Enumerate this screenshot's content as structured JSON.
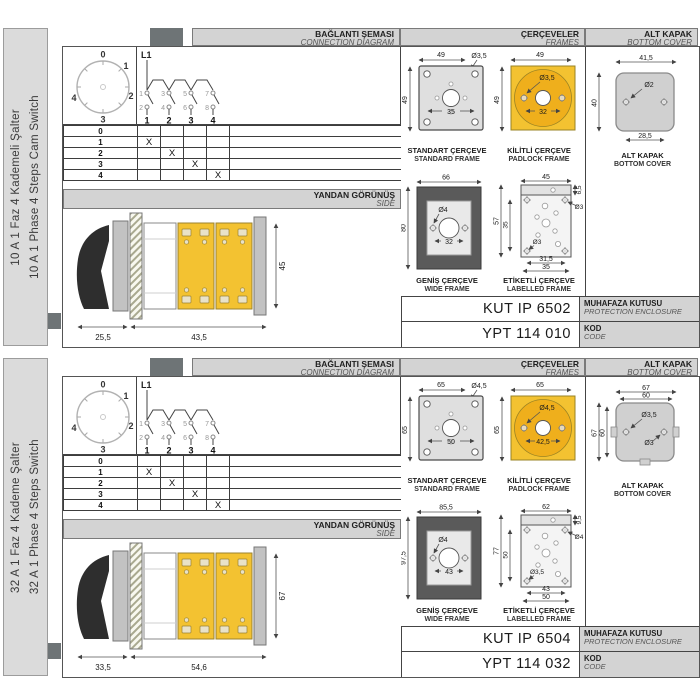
{
  "colors": {
    "yellow": "#F3C231",
    "amber": "#EFAF1C",
    "frame_gray": "#DFDFDF",
    "dark_frame": "#5A5A5A",
    "cover_gray": "#D0D0D0",
    "header_bg": "#D3D3D3",
    "sidebar_bg": "#DBDBDB",
    "tab_gray": "#6E7476",
    "line": "#444444"
  },
  "sections": [
    {
      "sidebar": {
        "tr": "10 A 1 Faz 4 Kademeli Şalter",
        "en": "10 A 1 Phase 4 Steps Cam Switch"
      },
      "headers": {
        "connection_tr": "BAĞLANTI ŞEMASI",
        "connection_en": "CONNECTION DIAGRAM",
        "frames_tr": "ÇERÇEVELER",
        "frames_en": "FRAMES",
        "cover_tr": "ALT KAPAK",
        "cover_en": "BOTTOM COVER",
        "side_tr": "YANDAN GÖRÜNÜŞ",
        "side_en": "SIDE"
      },
      "dial": {
        "positions": [
          "0",
          "1",
          "2",
          "3",
          "4"
        ]
      },
      "schem": {
        "phase": "L1",
        "odd": [
          "1",
          "3",
          "5",
          "7"
        ],
        "even": [
          "2",
          "4",
          "6",
          "8"
        ],
        "out": [
          "1",
          "2",
          "3",
          "4"
        ]
      },
      "table": {
        "rows": [
          {
            "pos": "0",
            "m": [
              "",
              "",
              "",
              ""
            ]
          },
          {
            "pos": "1",
            "m": [
              "X",
              "",
              "",
              ""
            ]
          },
          {
            "pos": "2",
            "m": [
              "",
              "X",
              "",
              ""
            ]
          },
          {
            "pos": "3",
            "m": [
              "",
              "",
              "X",
              ""
            ]
          },
          {
            "pos": "4",
            "m": [
              "",
              "",
              "",
              "X"
            ]
          }
        ]
      },
      "side_view": {
        "w1": "25,5",
        "w2": "43,5",
        "h": "45"
      },
      "frames": {
        "standard": {
          "tr": "STANDART ÇERÇEVE",
          "en": "STANDARD FRAME",
          "w": "49",
          "h": "49",
          "hole": "Ø3,5",
          "inner": "35"
        },
        "padlock": {
          "tr": "KİLİTLİ ÇERÇEVE",
          "en": "PADLOCK FRAME",
          "w": "49",
          "h": "49",
          "hole": "Ø3,5",
          "inner": "32"
        },
        "wide": {
          "tr": "GENİŞ ÇERÇEVE",
          "en": "WIDE FRAME",
          "w": "66",
          "h": "80",
          "hole": "Ø4",
          "inner": "32"
        },
        "labelled": {
          "tr": "ETİKETLİ ÇERÇEVE",
          "en": "LABELLED FRAME",
          "top": "45",
          "strip": "6,5",
          "h": "57",
          "inner_v": "35",
          "hole_r": "Ø3",
          "hole_l": "Ø3",
          "b1": "31,5",
          "b2": "35"
        }
      },
      "cover": {
        "tr": "ALT KAPAK",
        "en": "BOTTOM COVER",
        "w_out": "41,5",
        "w_in": "",
        "h_out": "40",
        "h_in": "",
        "hole1": "Ø2",
        "hole2": "",
        "b": "28,5"
      },
      "codes": {
        "enclosure": "KUT IP 6502",
        "enclosure_tr": "MUHAFAZA KUTUSU",
        "enclosure_en": "PROTECTION ENCLOSURE",
        "code": "YPT 114 010",
        "code_tr": "KOD",
        "code_en": "CODE"
      }
    },
    {
      "sidebar": {
        "tr": "32 A 1 Faz 4 Kademe Şalter",
        "en": "32 A 1 Phase 4 Steps Switch"
      },
      "headers": {
        "connection_tr": "BAĞLANTI ŞEMASI",
        "connection_en": "CONNECTION DIAGRAM",
        "frames_tr": "ÇERÇEVELER",
        "frames_en": "FRAMES",
        "cover_tr": "ALT KAPAK",
        "cover_en": "BOTTOM COVER",
        "side_tr": "YANDAN GÖRÜNÜŞ",
        "side_en": "SIDE"
      },
      "dial": {
        "positions": [
          "0",
          "1",
          "2",
          "3",
          "4"
        ]
      },
      "schem": {
        "phase": "L1",
        "odd": [
          "1",
          "3",
          "5",
          "7"
        ],
        "even": [
          "2",
          "4",
          "6",
          "8"
        ],
        "out": [
          "1",
          "2",
          "3",
          "4"
        ]
      },
      "table": {
        "rows": [
          {
            "pos": "0",
            "m": [
              "",
              "",
              "",
              ""
            ]
          },
          {
            "pos": "1",
            "m": [
              "X",
              "",
              "",
              ""
            ]
          },
          {
            "pos": "2",
            "m": [
              "",
              "X",
              "",
              ""
            ]
          },
          {
            "pos": "3",
            "m": [
              "",
              "",
              "X",
              ""
            ]
          },
          {
            "pos": "4",
            "m": [
              "",
              "",
              "",
              "X"
            ]
          }
        ]
      },
      "side_view": {
        "w1": "33,5",
        "w2": "54,6",
        "h": "67"
      },
      "frames": {
        "standard": {
          "tr": "STANDART ÇERÇEVE",
          "en": "STANDARD FRAME",
          "w": "65",
          "h": "65",
          "hole": "Ø4,5",
          "inner": "50"
        },
        "padlock": {
          "tr": "KİLİTLİ ÇERÇEVE",
          "en": "PADLOCK FRAME",
          "w": "65",
          "h": "65",
          "hole": "Ø4,5",
          "inner": "42,5"
        },
        "wide": {
          "tr": "GENİŞ ÇERÇEVE",
          "en": "WIDE FRAME",
          "w": "85,5",
          "h": "97,5",
          "hole": "Ø4",
          "inner": "43"
        },
        "labelled": {
          "tr": "ETİKETLİ ÇERÇEVE",
          "en": "LABELLED FRAME",
          "top": "62",
          "strip": "9,5",
          "h": "77",
          "inner_v": "50",
          "hole_r": "Ø4",
          "hole_l": "Ø3,5",
          "b1": "43",
          "b2": "50"
        }
      },
      "cover": {
        "tr": "ALT KAPAK",
        "en": "BOTTOM COVER",
        "w_out": "67",
        "w_in": "60",
        "h_out": "67",
        "h_in": "60",
        "hole1": "Ø3,5",
        "hole2": "Ø3",
        "b": ""
      },
      "codes": {
        "enclosure": "KUT IP 6504",
        "enclosure_tr": "MUHAFAZA KUTUSU",
        "enclosure_en": "PROTECTION ENCLOSURE",
        "code": "YPT 114 032",
        "code_tr": "KOD",
        "code_en": "CODE"
      }
    }
  ]
}
